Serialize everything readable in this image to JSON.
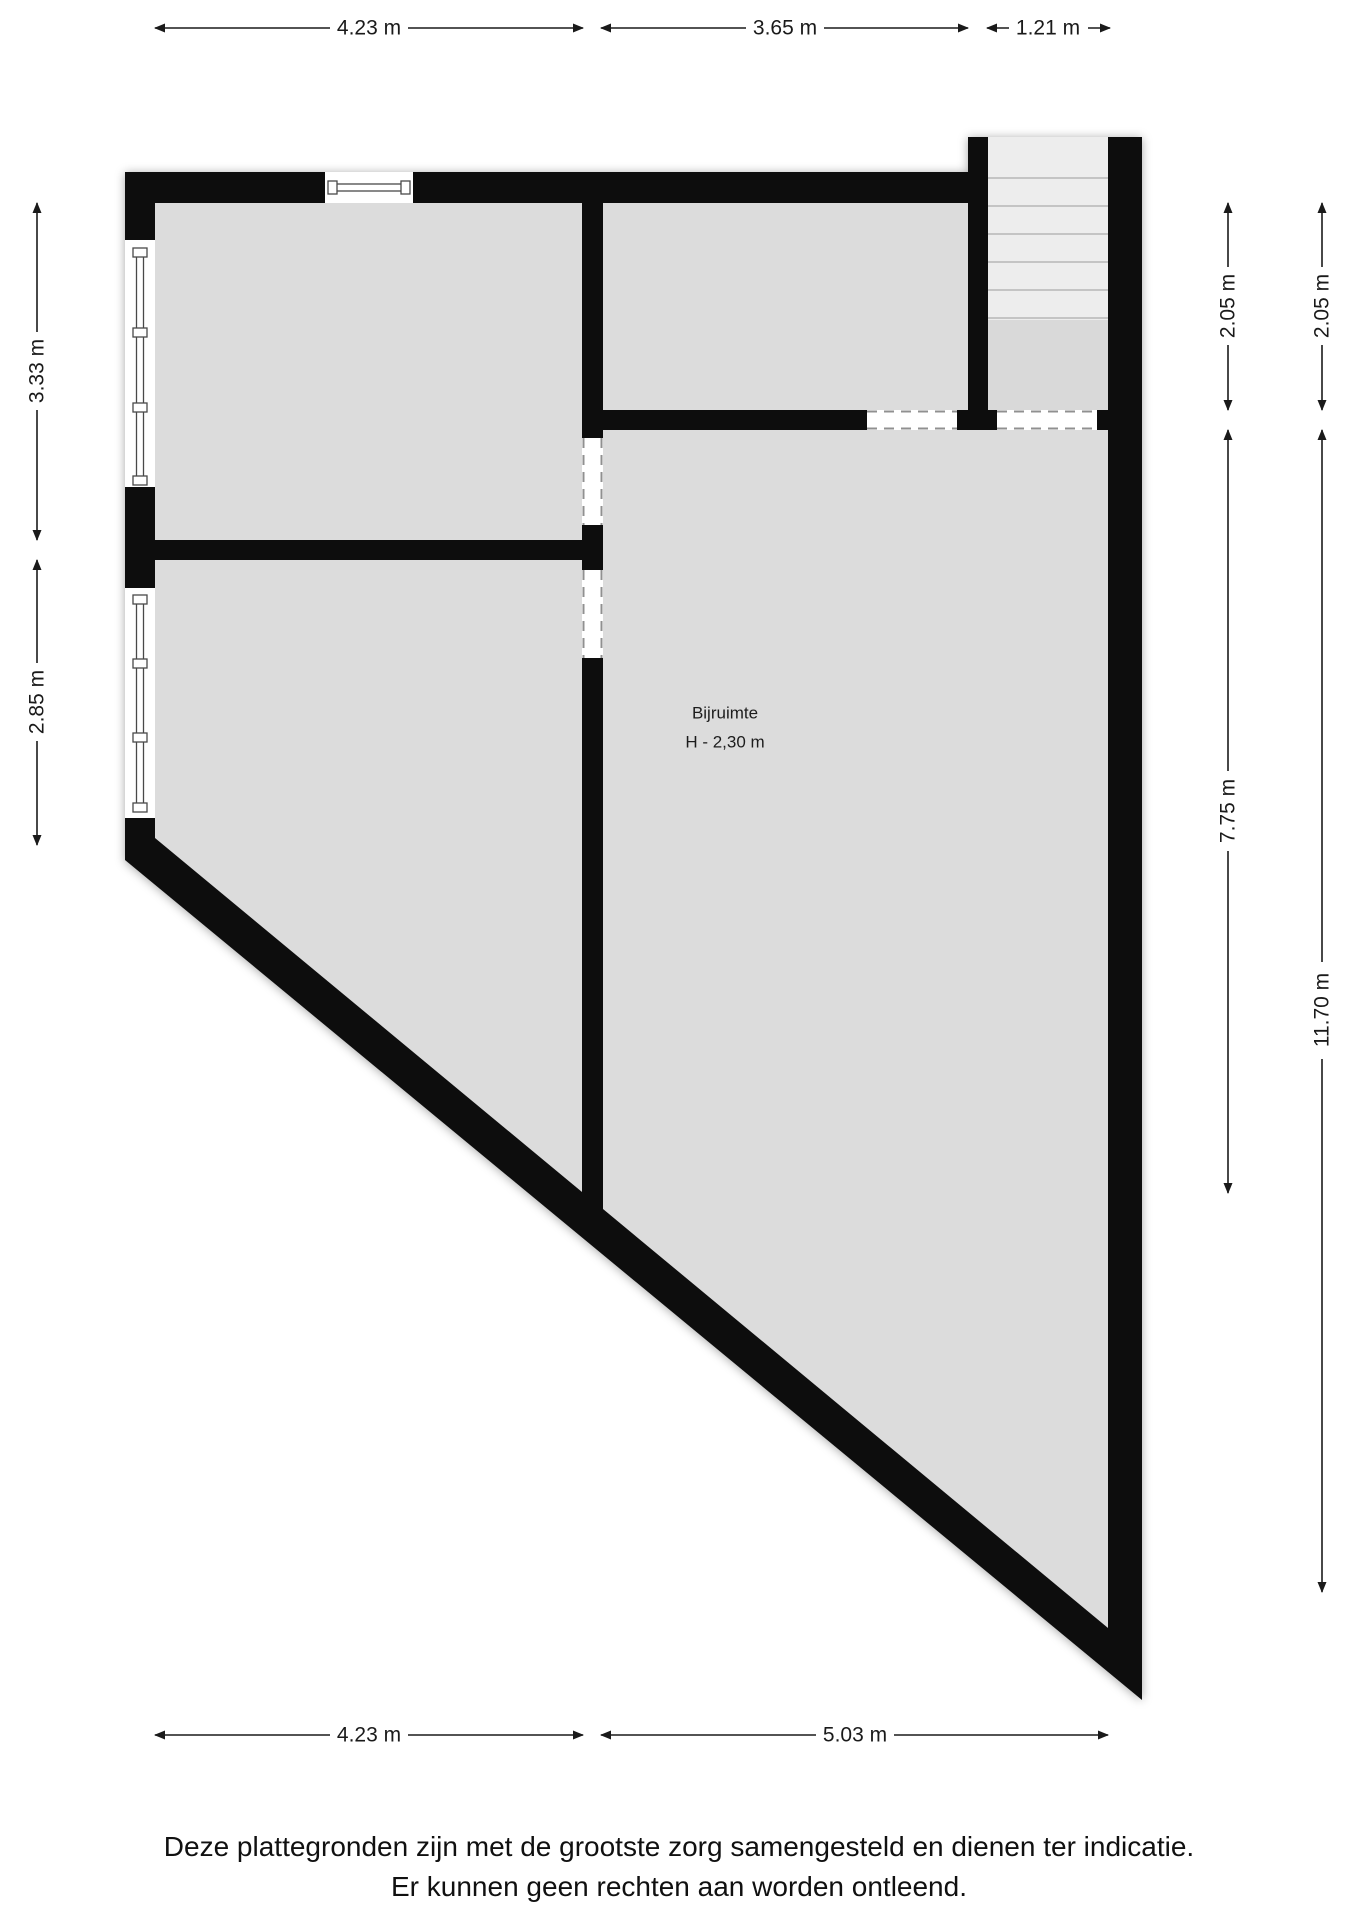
{
  "dimensions": {
    "top": [
      {
        "label": "4.23 m"
      },
      {
        "label": "3.65 m"
      },
      {
        "label": "1.21 m"
      }
    ],
    "bottom": [
      {
        "label": "4.23 m"
      },
      {
        "label": "5.03 m"
      }
    ],
    "left": [
      {
        "label": "3.33 m"
      },
      {
        "label": "2.85 m"
      }
    ],
    "right": [
      {
        "label": "2.05 m"
      },
      {
        "label": "2.05 m"
      },
      {
        "label": "7.75 m"
      },
      {
        "label": "11.70 m"
      }
    ]
  },
  "room": {
    "name": "Bijruimte",
    "height_label": "H - 2,30 m"
  },
  "disclaimer": {
    "line1": "Deze plattegronden zijn met de grootste zorg samengesteld en dienen ter indicatie.",
    "line2": "Er kunnen geen rechten aan worden ontleend."
  },
  "colors": {
    "wall": "#0b0b0b",
    "floor": "#dcdcdc",
    "stair_floor": "#ededed",
    "dash": "#909090",
    "background": "#ffffff"
  }
}
